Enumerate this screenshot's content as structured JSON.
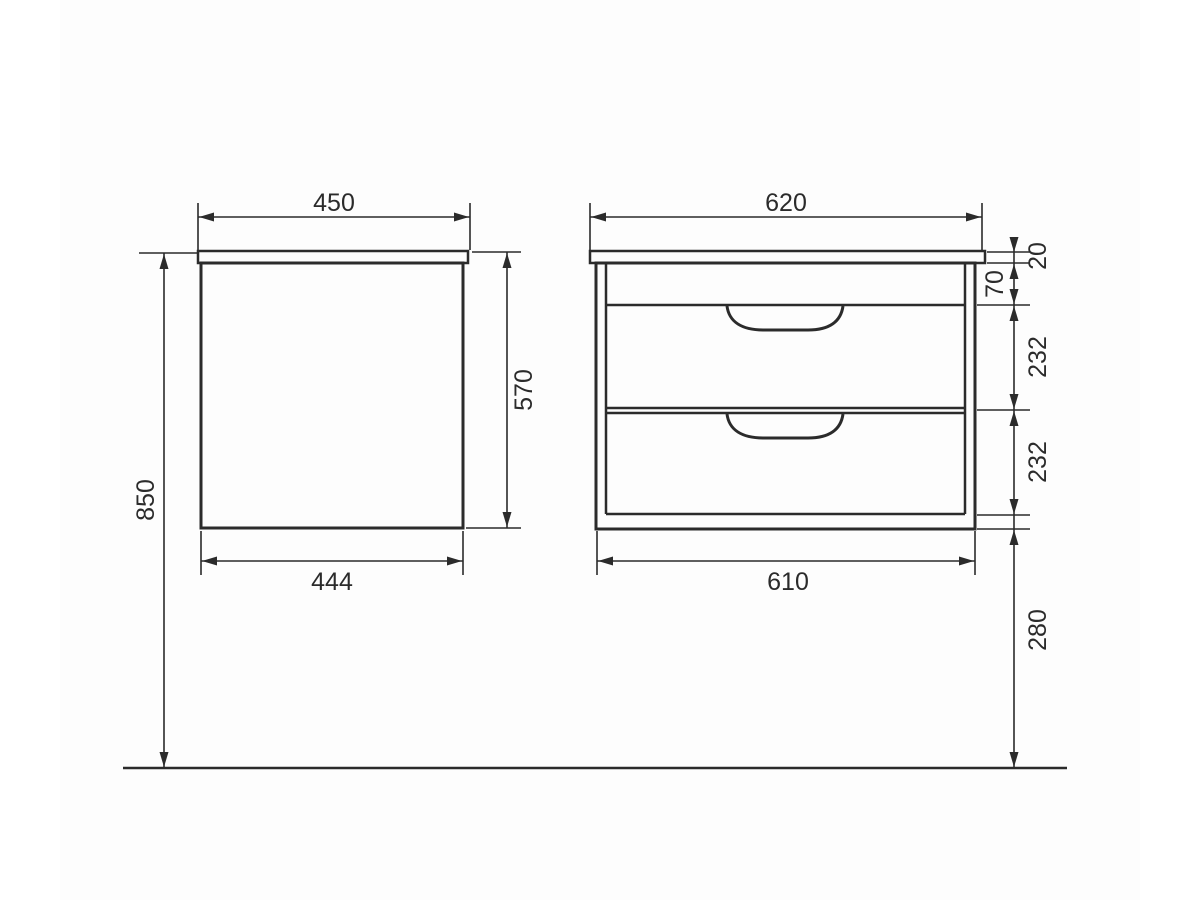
{
  "drawing": {
    "line_color": "#2b2b2b",
    "background_color": "#ffffff",
    "side_view": {
      "top_width": "450",
      "cabinet_height": "570",
      "bottom_width": "444",
      "overall_height": "850"
    },
    "front_view": {
      "top_width": "620",
      "countertop_thickness": "20",
      "apron_height": "70",
      "upper_drawer_height": "232",
      "lower_drawer_height": "232",
      "cabinet_width": "610",
      "floor_clearance": "280"
    }
  }
}
